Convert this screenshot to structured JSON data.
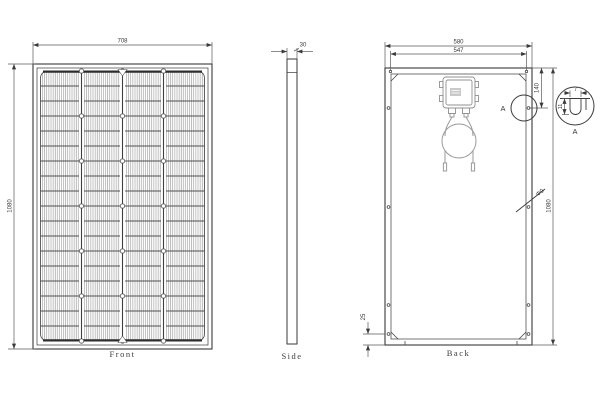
{
  "views": {
    "front": {
      "label": "Front",
      "width": "708",
      "height": "1080"
    },
    "side": {
      "label": "Side",
      "thickness": "30"
    },
    "back": {
      "label": "Back",
      "width": "580",
      "hole_span": "547",
      "height": "1080",
      "hole_top_offset": "140",
      "hole_bottom_offset": "25",
      "drain_hole": "Φ9",
      "detail_callout": "A"
    },
    "detail": {
      "label": "A",
      "slot_width": "7",
      "slot_depth": "11"
    }
  },
  "colors": {
    "background": "#ffffff",
    "line": "#3a3a3a",
    "fine_grid": "#8c8c8c",
    "cable_gray": "#949494"
  }
}
